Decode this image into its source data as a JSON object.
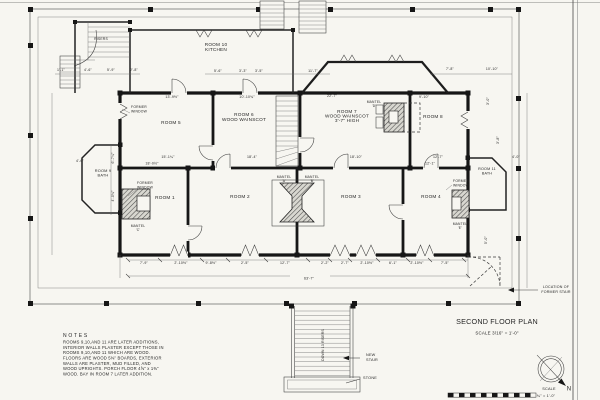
{
  "title_block": {
    "title": "SECOND FLOOR PLAN",
    "scale": "SCALE  3/16\" = 1'-0\"",
    "compass_scale_label": "SCALE",
    "compass_scale": "¾\" = 1'-0\"",
    "north": "N"
  },
  "notes": {
    "heading": "N O T E S",
    "lines": [
      "ROOMS 9,10,AND 11 ARE LATER ADDITIONS,",
      "INTERIOR WALLS PLASTER EXCEPT THOSE IN",
      "ROOMS 9,10,AND 11 WHICH ARE WOOD.",
      "FLOORS ARE WOOD 5⅜\" BOARDS, EXTERIOR",
      "WALLS ARE PLASTER, MUD FILLED, AND",
      "WOOD UPRIGHTS. PORCH FLOOR 4⅝\" x 1⅜\"",
      "WOOD.  BAY IN ROOM 7 LATER ADDITION."
    ]
  },
  "rooms": [
    {
      "n": "room-label-5",
      "lines": [
        "ROOM 5"
      ],
      "x": 171,
      "y": 124,
      "ls": 1
    },
    {
      "n": "room-label-6",
      "lines": [
        "ROOM 6",
        "WOOD WAINSCOT"
      ],
      "x": 244,
      "y": 116,
      "lh": 5,
      "ls": 1
    },
    {
      "n": "room-label-7",
      "lines": [
        "ROOM 7",
        "WOOD WAINSCOT",
        "3'-7\" HIGH"
      ],
      "x": 347,
      "y": 113,
      "lh": 4.6,
      "ls": 1
    },
    {
      "n": "room-label-8",
      "lines": [
        "ROOM 8"
      ],
      "x": 433,
      "y": 118,
      "ls": 1
    },
    {
      "n": "room-label-1",
      "lines": [
        "ROOM 1"
      ],
      "x": 165,
      "y": 199,
      "ls": 1
    },
    {
      "n": "room-label-2",
      "lines": [
        "ROOM 2"
      ],
      "x": 240,
      "y": 198,
      "ls": 1
    },
    {
      "n": "room-label-3",
      "lines": [
        "ROOM 3"
      ],
      "x": 351,
      "y": 198,
      "ls": 1
    },
    {
      "n": "room-label-4",
      "lines": [
        "ROOM 4"
      ],
      "x": 431,
      "y": 198,
      "ls": 1
    },
    {
      "n": "room-label-9",
      "lines": [
        "ROOM 9",
        "BATH"
      ],
      "x": 103,
      "y": 172,
      "lh": 4.6,
      "s": 3.9
    },
    {
      "n": "room-label-10",
      "lines": [
        "ROOM 10",
        "KITCHEN"
      ],
      "x": 216,
      "y": 46,
      "lh": 5,
      "ls": 1
    },
    {
      "n": "room-label-11",
      "lines": [
        "ROOM 11",
        "BATH"
      ],
      "x": 487,
      "y": 170,
      "lh": 4.4,
      "s": 3.7
    }
  ],
  "annotations": [
    {
      "t": "FORMER",
      "x": 139,
      "y": 108,
      "s": 3.4
    },
    {
      "t": "WINDOW",
      "x": 139,
      "y": 112.4,
      "s": 3.4
    },
    {
      "t": "FORMER",
      "x": 145,
      "y": 184,
      "s": 3.4
    },
    {
      "t": "WINDOW",
      "x": 145,
      "y": 188.4,
      "s": 3.4
    },
    {
      "t": "FORMER",
      "x": 461,
      "y": 182,
      "s": 3.4
    },
    {
      "t": "WINDOW",
      "x": 461,
      "y": 186.4,
      "s": 3.4
    },
    {
      "t": "MANTEL",
      "x": 138,
      "y": 227,
      "s": 3.3
    },
    {
      "t": "'C'",
      "x": 138,
      "y": 231,
      "s": 3.3
    },
    {
      "t": "MANTEL",
      "x": 284,
      "y": 178,
      "s": 3.3
    },
    {
      "t": "'A'",
      "x": 284,
      "y": 182,
      "s": 3.3
    },
    {
      "t": "MANTEL",
      "x": 312,
      "y": 178,
      "s": 3.3
    },
    {
      "t": "'B'",
      "x": 312,
      "y": 182,
      "s": 3.3
    },
    {
      "t": "MANTEL",
      "x": 374,
      "y": 103,
      "s": 3.3
    },
    {
      "t": "'D'",
      "x": 374,
      "y": 107,
      "s": 3.3
    },
    {
      "t": "MANTEL",
      "x": 460,
      "y": 225,
      "s": 3.3
    },
    {
      "t": "'E'",
      "x": 460,
      "y": 229,
      "s": 3.3
    },
    {
      "t": "RISERS",
      "x": 101,
      "y": 40,
      "s": 3.4
    },
    {
      "t": "DOWN 13 RISERS",
      "x": 324,
      "y": 345,
      "r": -90,
      "s": 3.4
    },
    {
      "t": "NEW",
      "x": 366,
      "y": 356,
      "a": "start",
      "s": 3.8
    },
    {
      "t": "STAIR",
      "x": 366,
      "y": 361,
      "a": "start",
      "s": 3.8
    },
    {
      "t": "STONE",
      "x": 363,
      "y": 379,
      "a": "start",
      "s": 3.8
    },
    {
      "t": "LOCATION  OF",
      "x": 556,
      "y": 288,
      "s": 3.6
    },
    {
      "t": "FORMER  STAIR",
      "x": 556,
      "y": 293,
      "s": 3.6
    }
  ],
  "dimensions": [
    {
      "t": "1'-1\"",
      "x": 61,
      "y": 71
    },
    {
      "t": "4'-6\"",
      "x": 88,
      "y": 71
    },
    {
      "t": "5'-9\"",
      "x": 111,
      "y": 71
    },
    {
      "t": "2'-8\"",
      "x": 134,
      "y": 71
    },
    {
      "t": "5'-6\"",
      "x": 218,
      "y": 72
    },
    {
      "t": "3'-3\"",
      "x": 243,
      "y": 72
    },
    {
      "t": "3'-5\"",
      "x": 259,
      "y": 72
    },
    {
      "t": "11'-7\"",
      "x": 313,
      "y": 72
    },
    {
      "t": "7'-8\"",
      "x": 450,
      "y": 70
    },
    {
      "t": "10'-10\"",
      "x": 492,
      "y": 70
    },
    {
      "t": "13'-9½\"",
      "x": 172,
      "y": 98
    },
    {
      "t": "10'-10¾\"",
      "x": 247,
      "y": 98
    },
    {
      "t": "22'-7\"",
      "x": 332,
      "y": 97
    },
    {
      "t": "9'-10\"",
      "x": 424,
      "y": 98
    },
    {
      "t": "15'-1¼\"",
      "x": 168,
      "y": 158
    },
    {
      "t": "18'-4\"",
      "x": 252,
      "y": 158
    },
    {
      "t": "18'-10\"",
      "x": 356,
      "y": 158
    },
    {
      "t": "12'-7\"",
      "x": 438,
      "y": 158
    },
    {
      "t": "18'-0½\"",
      "x": 152,
      "y": 164.5
    },
    {
      "t": "12'-1\"",
      "x": 430,
      "y": 164.5
    },
    {
      "t": "4'-6\"",
      "x": 80,
      "y": 162
    },
    {
      "t": "6'-7¼\"",
      "x": 114,
      "y": 158,
      "r": -90
    },
    {
      "t": "4'-0¾\"",
      "x": 114,
      "y": 196,
      "r": -90
    },
    {
      "t": "3'-0\"",
      "x": 489,
      "y": 101,
      "r": -90
    },
    {
      "t": "3'-8\"",
      "x": 499,
      "y": 140,
      "r": -90
    },
    {
      "t": "5'-0\"",
      "x": 487,
      "y": 240,
      "r": -90
    },
    {
      "t": "4'-0\"",
      "x": 516,
      "y": 158
    },
    {
      "t": "7'-9\"",
      "x": 144,
      "y": 264
    },
    {
      "t": "2'-10½\"",
      "x": 181,
      "y": 264
    },
    {
      "t": "9'-8½\"",
      "x": 211,
      "y": 264
    },
    {
      "t": "2'-5\"",
      "x": 245,
      "y": 264
    },
    {
      "t": "12'-7\"",
      "x": 285,
      "y": 264
    },
    {
      "t": "2'-2\"",
      "x": 325,
      "y": 264
    },
    {
      "t": "2'-7\"",
      "x": 345,
      "y": 264
    },
    {
      "t": "2'-10½\"",
      "x": 367,
      "y": 264
    },
    {
      "t": "6'-1\"",
      "x": 393,
      "y": 264
    },
    {
      "t": "2'-10½\"",
      "x": 417,
      "y": 264
    },
    {
      "t": "7'-5\"",
      "x": 445,
      "y": 264
    },
    {
      "t": "63'-7\"",
      "x": 309,
      "y": 279.5
    }
  ],
  "colors": {
    "ink": "#161616",
    "paper": "#f7f6f1"
  }
}
